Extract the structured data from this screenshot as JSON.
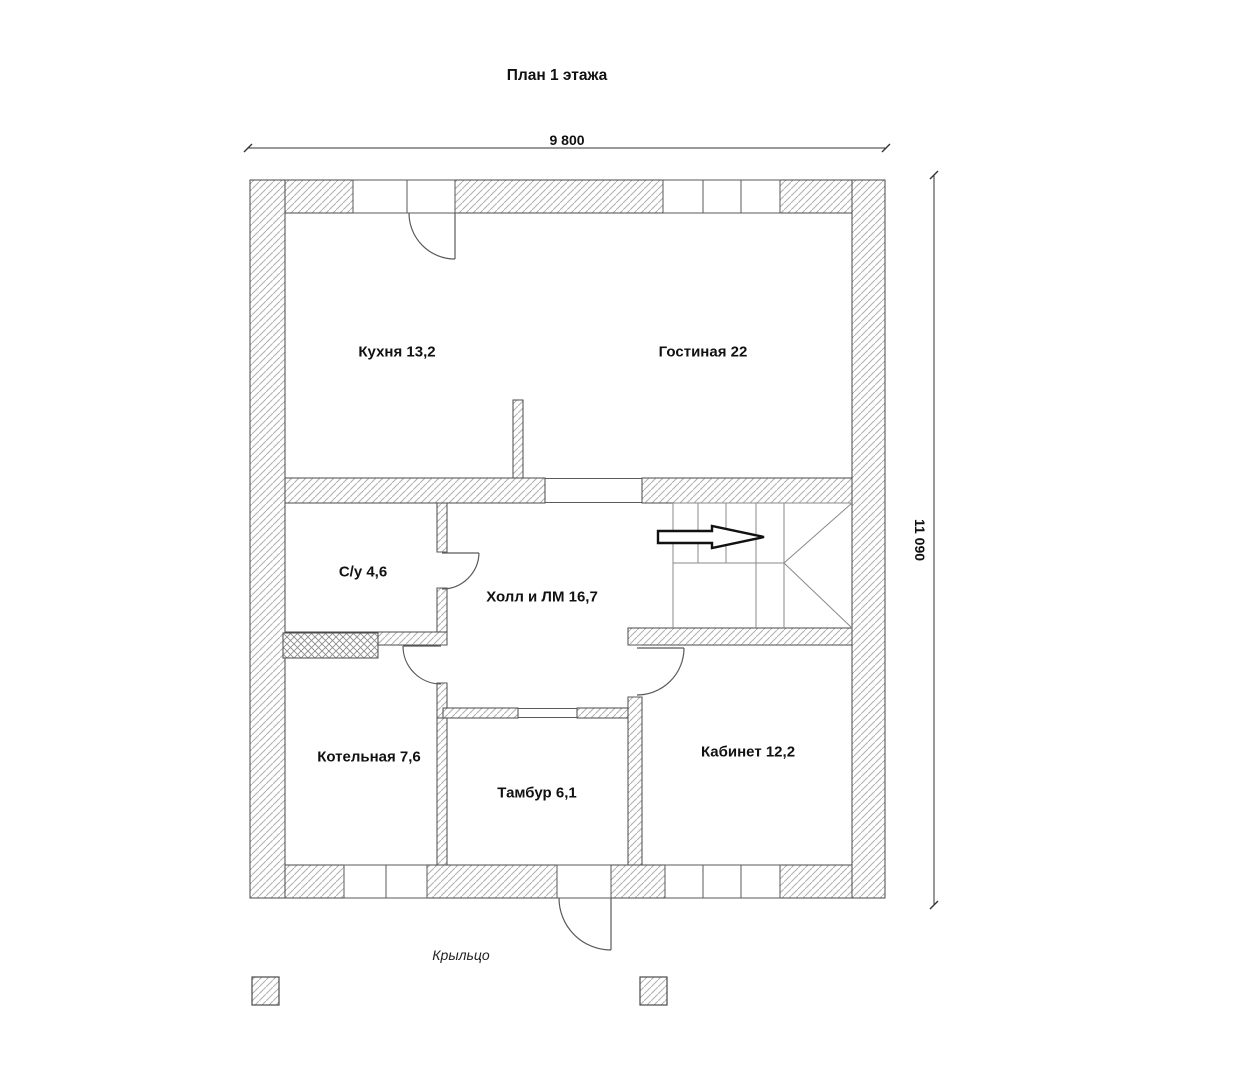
{
  "title": "План 1 этажа",
  "dimensions": {
    "top": "9 800",
    "right": "11 090"
  },
  "rooms": {
    "kitchen": {
      "name": "Кухня",
      "area": "13,2",
      "label": "Кухня 13,2"
    },
    "living": {
      "name": "Гостиная",
      "area": "22",
      "label": "Гостиная 22"
    },
    "bathroom": {
      "name": "С/у",
      "area": "4,6",
      "label": "С/у 4,6"
    },
    "hall": {
      "name": "Холл и ЛМ",
      "area": "16,7",
      "label": "Холл и ЛМ 16,7"
    },
    "boiler": {
      "name": "Котельная",
      "area": "7,6",
      "label": "Котельная 7,6"
    },
    "vestibule": {
      "name": "Тамбур",
      "area": "6,1",
      "label": "Тамбур 6,1"
    },
    "office": {
      "name": "Кабинет",
      "area": "12,2",
      "label": "Кабинет 12,2"
    }
  },
  "annotations": {
    "porch": "Крыльцо"
  },
  "colors": {
    "background": "#ffffff",
    "wall_hatch": "#b0b0b0",
    "wall_border": "#4a4a4a",
    "thin_line": "#5a5a5a",
    "stair_line": "#8a8a8a",
    "dimension_line": "#333333",
    "text": "#111111"
  }
}
